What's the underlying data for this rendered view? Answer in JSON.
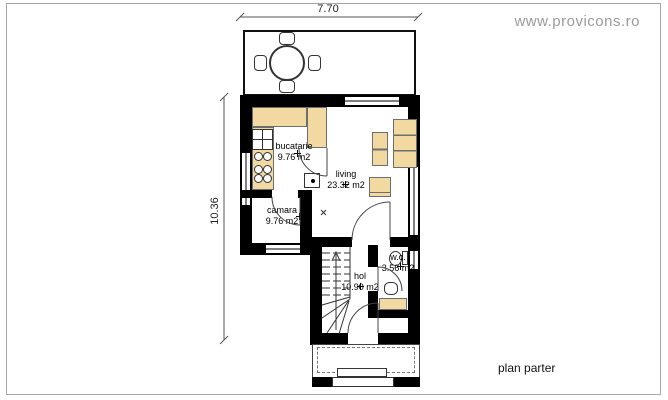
{
  "watermark": "www.provicons.ro",
  "plan": {
    "title": "plan parter"
  },
  "dimensions": {
    "width": "7.70",
    "height": "10.36"
  },
  "rooms": {
    "bucatarie": {
      "name": "bucatarie",
      "area": "9.76 m2"
    },
    "living": {
      "name": "living",
      "area": "23.32 m2"
    },
    "camara": {
      "name": "camara",
      "area": "9.76 m2"
    },
    "hol": {
      "name": "hol",
      "area": "10.90 m2"
    },
    "wc": {
      "name": "w.c.",
      "area": "3.56 m2"
    }
  },
  "colors": {
    "wall": "#000000",
    "furniture": "#f2d9a2",
    "dimension_line": "#555555",
    "watermark_text": "#9a9a9a",
    "frame": "#a6a6a6"
  }
}
